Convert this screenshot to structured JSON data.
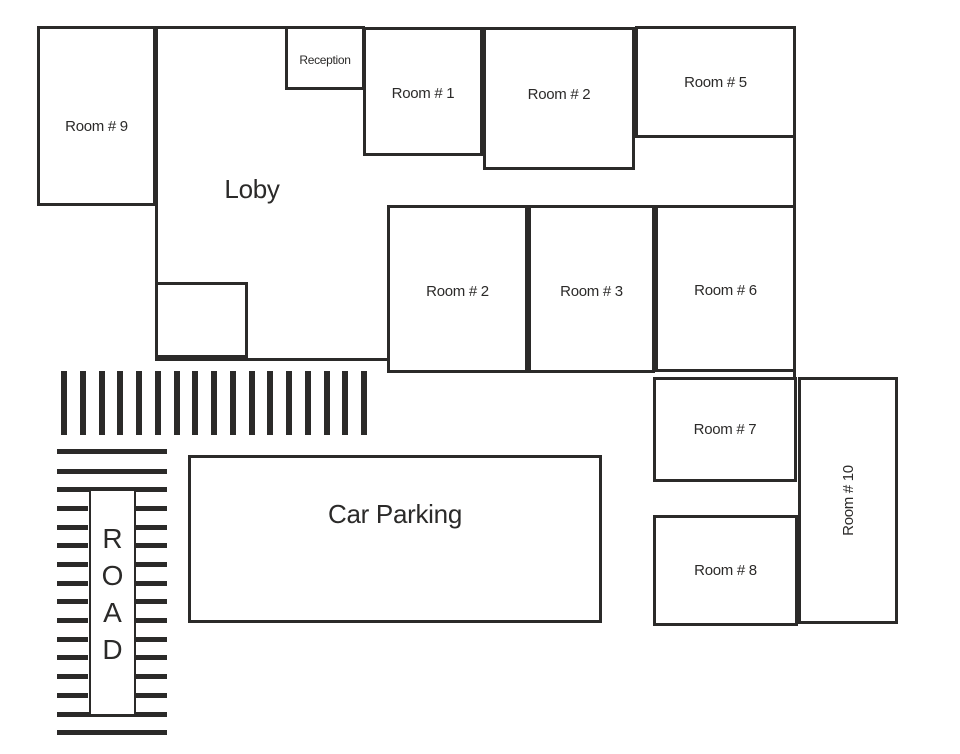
{
  "diagram": {
    "type": "hotel-floor-plan",
    "background_color": "#ffffff",
    "wall_color": "#2b2a29",
    "text_color": "#2b2a29"
  },
  "rooms": [
    {
      "id": "room-9",
      "label": "Room # 9",
      "x": 37,
      "y": 26,
      "w": 119,
      "h": 180,
      "font": 15,
      "dy": 10
    },
    {
      "id": "reception",
      "label": "Reception",
      "x": 285,
      "y": 26,
      "w": 80,
      "h": 64,
      "font": 12,
      "dy": 2
    },
    {
      "id": "room-1",
      "label": "Room # 1",
      "x": 363,
      "y": 27,
      "w": 120,
      "h": 129,
      "font": 15,
      "dy": 2
    },
    {
      "id": "room-2-top",
      "label": "Room # 2",
      "x": 483,
      "y": 27,
      "w": 152,
      "h": 143,
      "font": 15,
      "dy": -4
    },
    {
      "id": "room-5",
      "label": "Room # 5",
      "x": 635,
      "y": 26,
      "w": 161,
      "h": 112,
      "font": 15,
      "dy": 0
    },
    {
      "id": "room-2-middle",
      "label": "Room # 2",
      "x": 387,
      "y": 205,
      "w": 141,
      "h": 168,
      "font": 15,
      "dy": 2
    },
    {
      "id": "room-3",
      "label": "Room # 3",
      "x": 528,
      "y": 205,
      "w": 127,
      "h": 168,
      "font": 15,
      "dy": 2
    },
    {
      "id": "room-6",
      "label": "Room # 6",
      "x": 655,
      "y": 205,
      "w": 141,
      "h": 167,
      "font": 15,
      "dy": 2
    },
    {
      "id": "room-7",
      "label": "Room # 7",
      "x": 653,
      "y": 377,
      "w": 144,
      "h": 105,
      "font": 15,
      "dy": 0
    },
    {
      "id": "room-10",
      "label": "Room # 10",
      "x": 798,
      "y": 377,
      "w": 100,
      "h": 247,
      "font": 15,
      "dy": 0,
      "vertical": true
    },
    {
      "id": "room-8",
      "label": "Room # 8",
      "x": 653,
      "y": 515,
      "w": 145,
      "h": 111,
      "font": 15,
      "dy": 0
    },
    {
      "id": "car-parking",
      "label": "Car Parking",
      "x": 188,
      "y": 455,
      "w": 414,
      "h": 168,
      "font": 26,
      "dy": -25
    },
    {
      "id": "loby-alcove",
      "label": "",
      "x": 155,
      "y": 282,
      "w": 93,
      "h": 76,
      "font": 0,
      "dy": 0
    }
  ],
  "free_labels": [
    {
      "id": "loby",
      "text": "Loby",
      "x": 252,
      "y": 189,
      "font": 26
    }
  ],
  "extra_walls": [
    {
      "id": "top-wall-segment",
      "x": 155,
      "y": 26,
      "w": 133,
      "h": 3
    },
    {
      "id": "loby-left-wall",
      "x": 155,
      "y": 26,
      "w": 3,
      "h": 335
    },
    {
      "id": "loby-bottom-wall",
      "x": 155,
      "y": 358,
      "w": 234,
      "h": 3
    },
    {
      "id": "right-wall-segment",
      "x": 793,
      "y": 136,
      "w": 3,
      "h": 244
    }
  ],
  "road": {
    "word": "ROAD",
    "letters": [
      "R",
      "O",
      "A",
      "D"
    ],
    "crosswalk_top": {
      "count": 17,
      "x0": 61,
      "step": 18.75,
      "y": 371,
      "bar_w": 6,
      "bar_h": 64
    },
    "full_bars": {
      "x": 57,
      "w": 110,
      "h": 5,
      "ys": [
        449,
        469,
        487,
        712,
        730
      ]
    },
    "side_bars": {
      "left_x": 57,
      "right_x": 136,
      "w": 31,
      "h": 5,
      "ys": [
        506,
        525,
        543,
        562,
        581,
        599,
        618,
        637,
        655,
        674,
        693
      ]
    },
    "label_box": {
      "x": 89,
      "y": 489,
      "w": 47,
      "h": 227
    }
  }
}
